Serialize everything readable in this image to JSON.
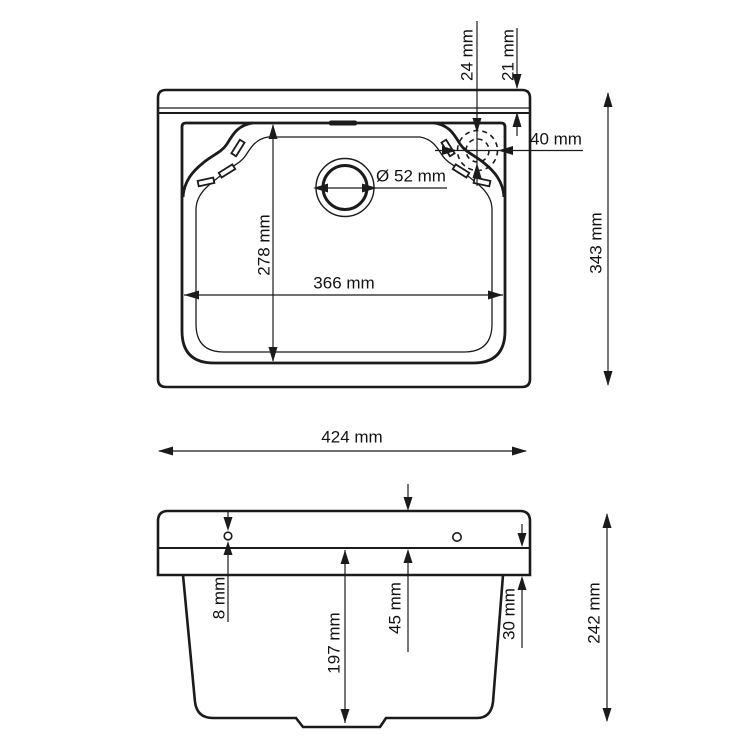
{
  "drawing": {
    "type": "technical-dimension-drawing",
    "subject": "utility-sink",
    "colors": {
      "line": "#1b1b1b",
      "text": "#121212",
      "background": "#ffffff"
    },
    "views": {
      "top": {
        "dim_24mm": "24 mm",
        "dim_21mm": "21 mm",
        "dim_40mm": "40 mm",
        "dim_drain": "Ø 52 mm",
        "dim_278mm": "278 mm",
        "dim_366mm": "366 mm",
        "dim_343mm": "343 mm",
        "dim_424mm": "424 mm"
      },
      "front": {
        "dim_8mm": "8 mm",
        "dim_197mm": "197 mm",
        "dim_45mm": "45 mm",
        "dim_30mm": "30 mm",
        "dim_242mm": "242 mm"
      }
    }
  }
}
